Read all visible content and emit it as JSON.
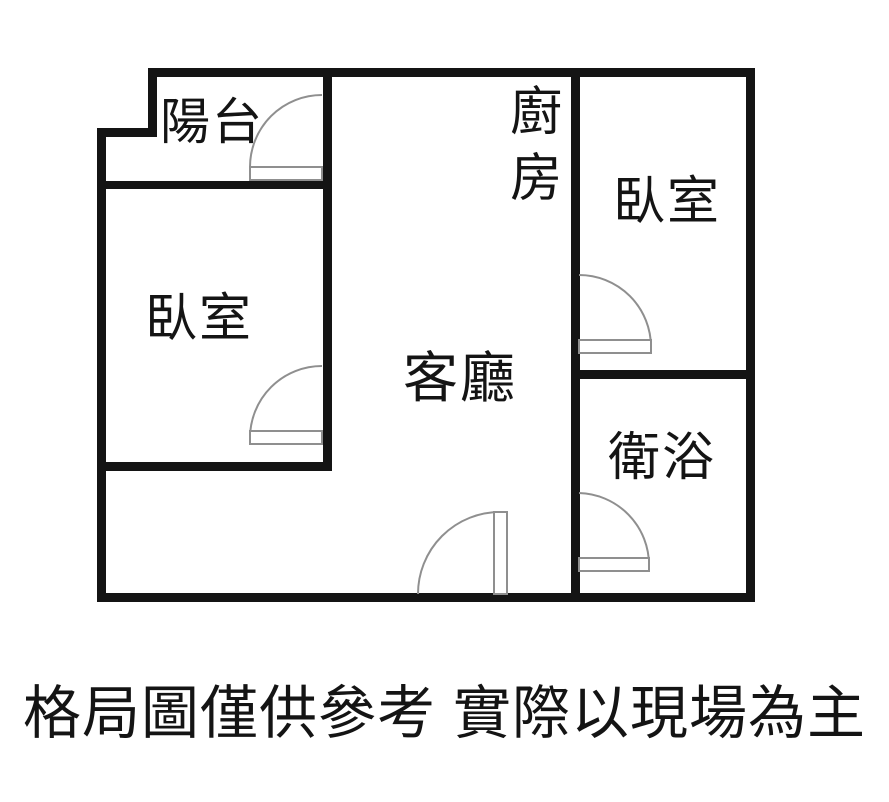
{
  "floorplan": {
    "title": "apartment-floor-plan",
    "rooms": [
      {
        "id": "balcony",
        "label": "陽台"
      },
      {
        "id": "kitchen",
        "label": "廚房"
      },
      {
        "id": "bedroom-right",
        "label": "臥室"
      },
      {
        "id": "bedroom-left",
        "label": "臥室"
      },
      {
        "id": "living-room",
        "label": "客廳"
      },
      {
        "id": "bathroom",
        "label": "衛浴"
      }
    ],
    "doors": [
      {
        "id": "door-balcony"
      },
      {
        "id": "door-bedroom-left"
      },
      {
        "id": "door-bedroom-right"
      },
      {
        "id": "door-bathroom"
      },
      {
        "id": "door-living-entry"
      }
    ]
  },
  "caption": {
    "text": "格局圖僅供參考 實際以現場為主"
  },
  "colors": {
    "background": "#ffffff",
    "wall": "#141414",
    "door_symbol": "#8f8f8f",
    "text": "#141414"
  }
}
